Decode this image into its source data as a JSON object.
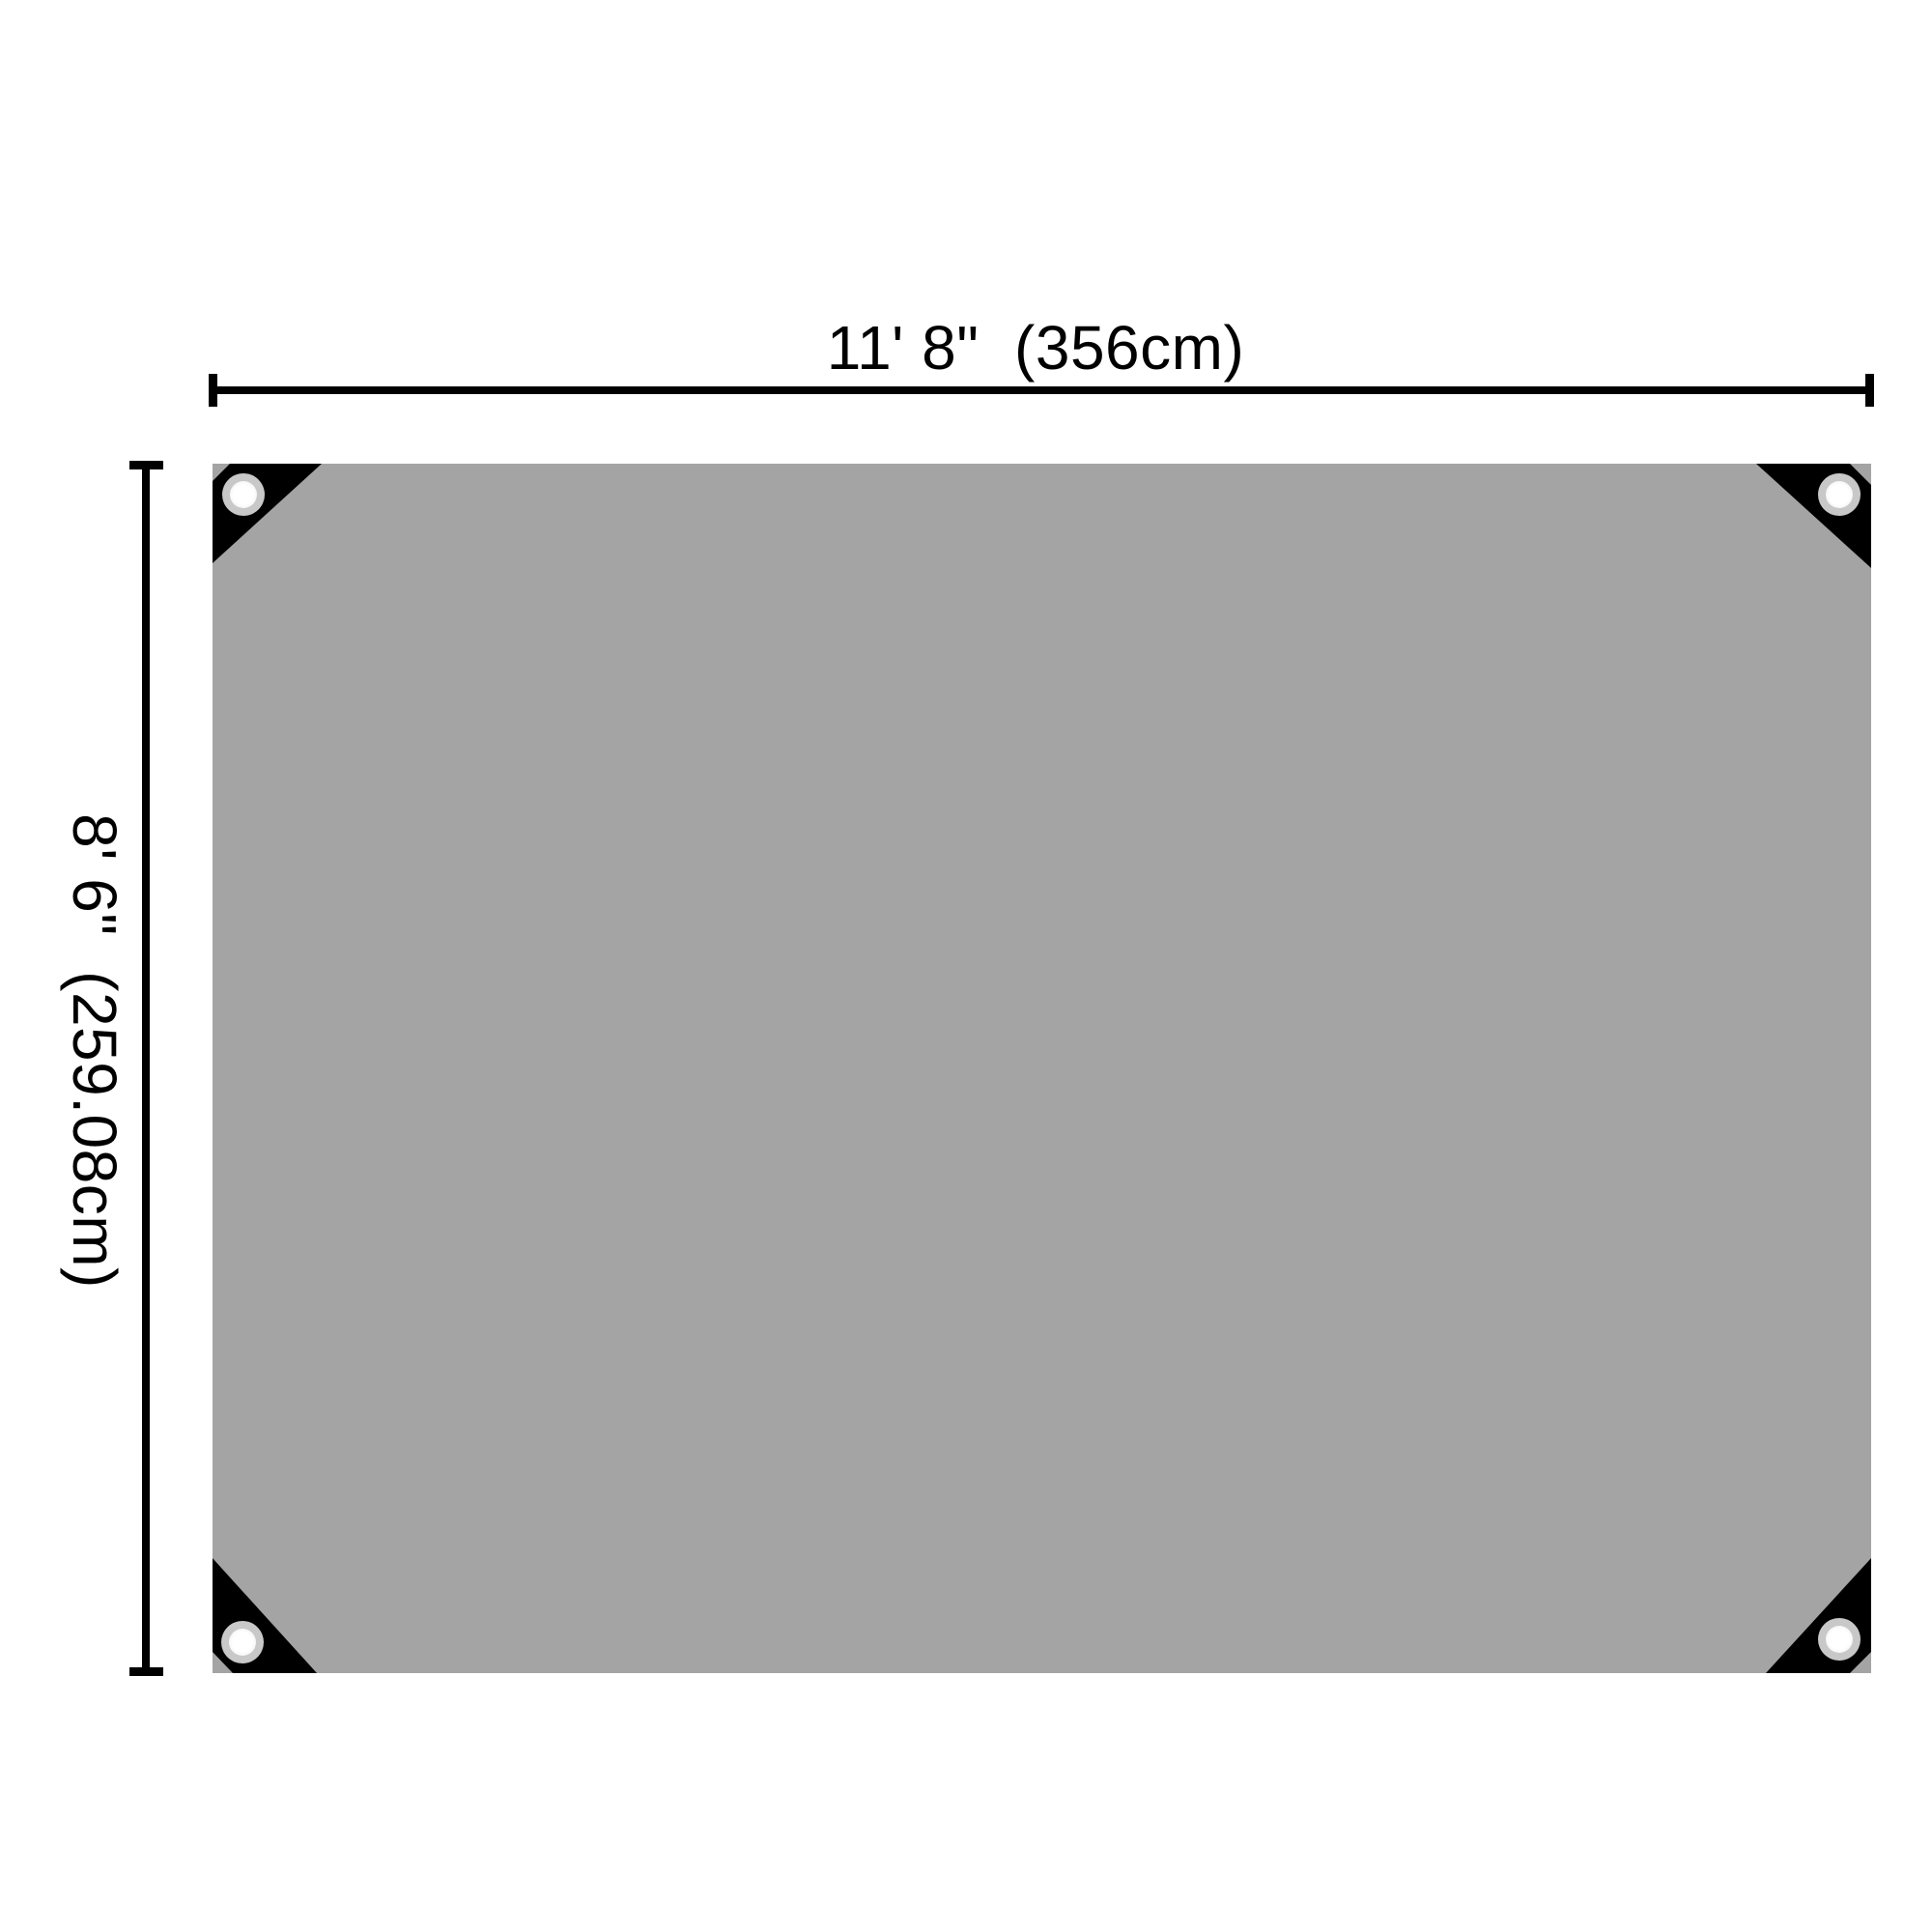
{
  "diagram": {
    "type": "product-dimension-diagram",
    "subject": "tarp sheet with reinforced corners and grommets",
    "width_label": "11' 8\"  (356cm)",
    "height_label": "8' 6\"  (259.08cm)",
    "grommet_positions": [
      "top-left",
      "top-right",
      "bottom-left",
      "bottom-right"
    ],
    "colors": {
      "background": "#ffffff",
      "tarp": "#a4a4a4",
      "corner_patch": "#000000",
      "grommet_ring": "#c8c8c8",
      "grommet_hole": "#ffffff",
      "dimension": "#000000"
    }
  }
}
